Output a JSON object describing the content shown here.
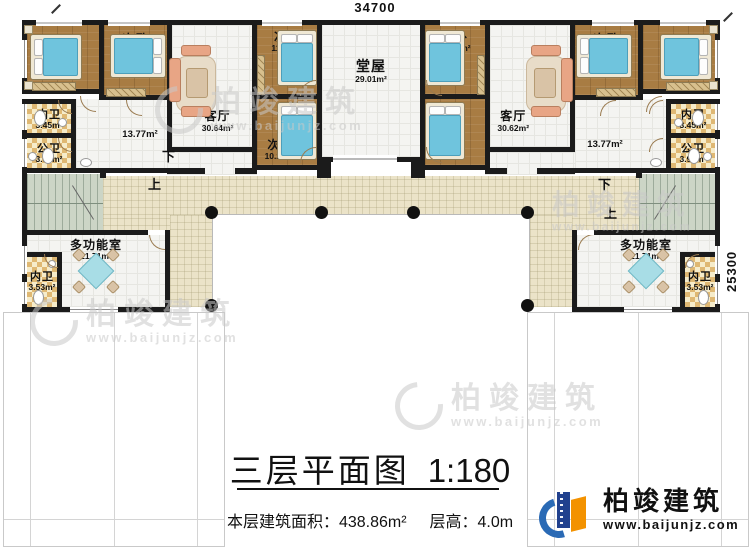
{
  "dimensions": {
    "width_label": "34700",
    "depth_label": "25300"
  },
  "rooms": [
    {
      "name": "主卧",
      "area": "16.11m²"
    },
    {
      "name": "次卧",
      "area": "11.88m²"
    },
    {
      "name": "客厅",
      "area": "30.64m²"
    },
    {
      "name": "次卧",
      "area": "11.51m²"
    },
    {
      "name": "次卧",
      "area": "10.28m²"
    },
    {
      "name": "堂屋",
      "area": "29.01m²"
    },
    {
      "name": "次卧",
      "area": "11.51m²"
    },
    {
      "name": "次卧",
      "area": "10.28m²"
    },
    {
      "name": "客厅",
      "area": "30.62m²"
    },
    {
      "name": "次卧",
      "area": "11.88m²"
    },
    {
      "name": "主卧",
      "area": "16.11m²"
    },
    {
      "name": "内卫",
      "area": "3.45m²"
    },
    {
      "name": "公卫",
      "area": "3.92m²"
    },
    {
      "name": "内卫",
      "area": "3.45m²"
    },
    {
      "name": "公卫",
      "area": "3.92m²"
    },
    {
      "name": "",
      "area": "13.77m²"
    },
    {
      "name": "",
      "area": "13.77m²"
    },
    {
      "name": "多功能室",
      "area": "21.71m²"
    },
    {
      "name": "内卫",
      "area": "3.53m²"
    },
    {
      "name": "多功能室",
      "area": "21.71m²"
    },
    {
      "name": "内卫",
      "area": "3.53m²"
    }
  ],
  "stairs": {
    "down": "下",
    "up": "上"
  },
  "title": {
    "text": "三层平面图",
    "scale": "1:180"
  },
  "info": {
    "area_label": "本层建筑面积：",
    "area_value": "438.86m²",
    "height_label": "层高：",
    "height_value": "4.0m"
  },
  "logo": {
    "name": "柏竣建筑",
    "url": "www.baijunjz.com"
  },
  "watermark": {
    "name": "柏竣建筑",
    "url": "www.baijunjz.com"
  },
  "colors": {
    "wall": "#1b1b1b",
    "wood_floor": "#a87c43",
    "bed": "#6fc4dd",
    "terrace": "#ebe3c8",
    "stair": "#ccd5c6",
    "bath_tile": "#dfb873",
    "logo_blue": "#2a6ab5",
    "logo_navy": "#21418e",
    "logo_orange": "#f39200",
    "watermark_gray": "#c9c9c9"
  }
}
